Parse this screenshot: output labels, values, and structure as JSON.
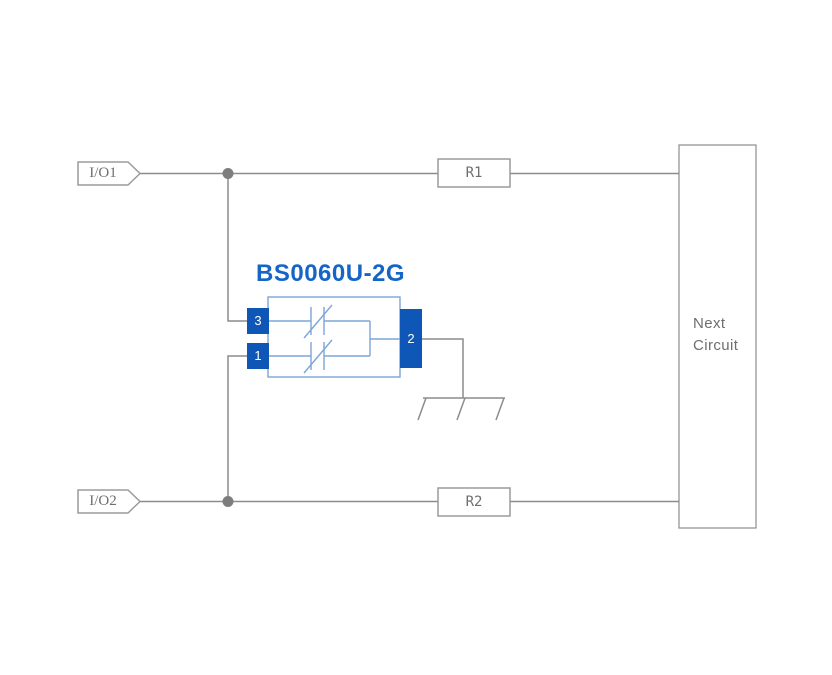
{
  "diagram": {
    "component": {
      "title": "BS0060U-2G",
      "pin_top_left": "3",
      "pin_bottom_left": "1",
      "pin_right": "2"
    },
    "labels": {
      "io1": "I/O1",
      "io2": "I/O2",
      "r1": "R1",
      "r2": "R2",
      "next_circuit_line1": "Next",
      "next_circuit_line2": "Circuit"
    },
    "icons": {
      "ground": "chassis-ground-icon",
      "junction": "junction-dot"
    }
  },
  "colors": {
    "background": "#ffffff",
    "wire": "#8c8c8c",
    "outline": "#9b9b9b",
    "label_text": "#6e6e6e",
    "junction_dot": "#7d7d7d",
    "pin_fill": "#0e57b6",
    "component_outline": "#7ca6d8",
    "title_blue": "#1565c8",
    "pin_text": "#ffffff"
  }
}
